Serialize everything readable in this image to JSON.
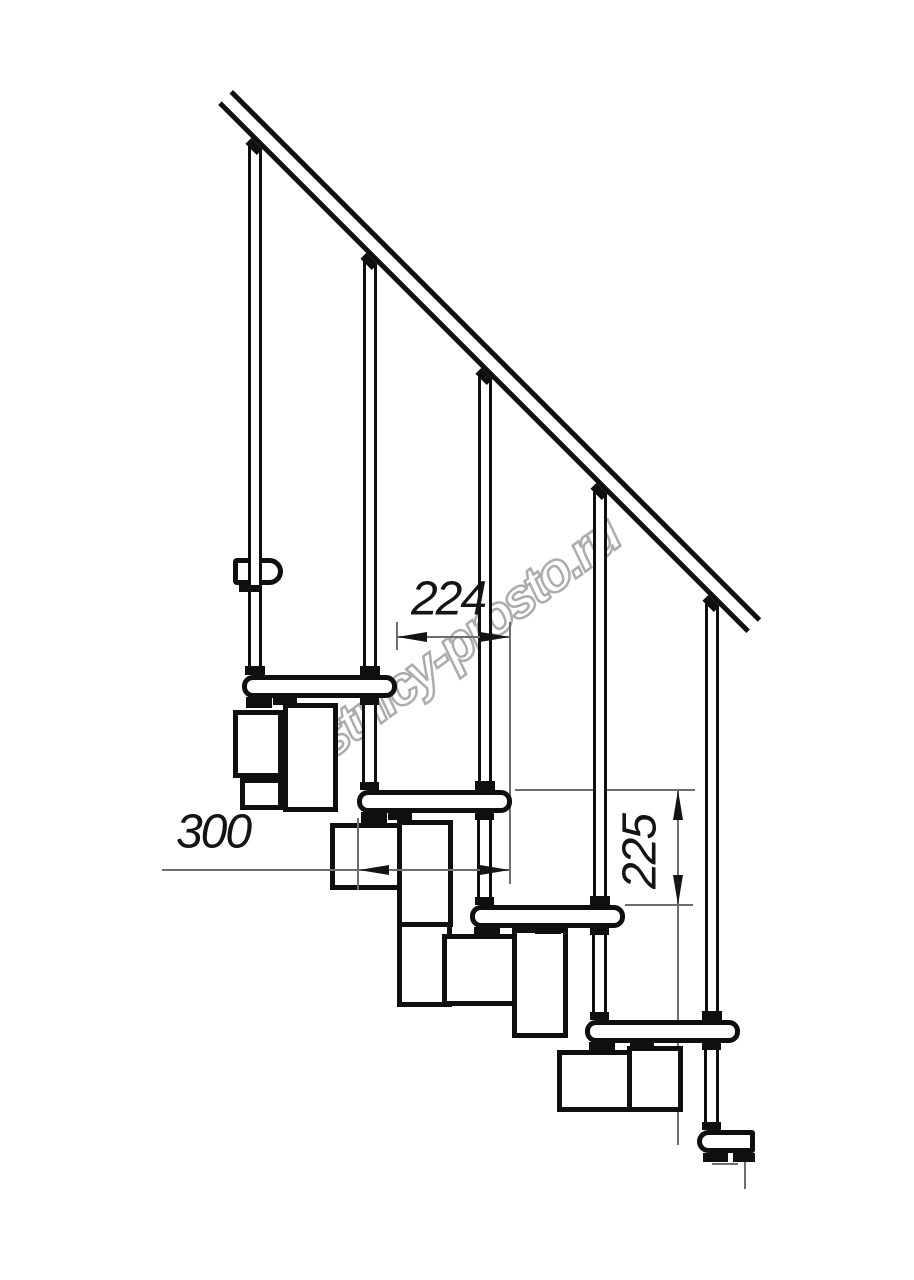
{
  "watermark": {
    "text": "lestnicy-prosto.ru"
  },
  "dimensions": {
    "step_run": {
      "label": "224"
    },
    "module_depth": {
      "label": "300"
    },
    "step_rise": {
      "label": "225"
    }
  },
  "colors": {
    "background": "#ffffff",
    "ink": "#0f0f0f",
    "thin_line": "#6e6e6e",
    "watermark_outline": "#acacac",
    "dimension_text": "#141414"
  },
  "geometry": {
    "handrail": {
      "x": 233,
      "y": 90,
      "length": 747,
      "thickness": 21,
      "angle_deg": 45
    },
    "treads": [
      [
        242,
        675,
        155,
        23
      ],
      [
        357,
        790,
        155,
        23
      ],
      [
        470,
        905,
        155,
        23
      ],
      [
        585,
        1020,
        155,
        23
      ]
    ],
    "rail_bracket": [
      233,
      558,
      50,
      27
    ],
    "floor_bracket": [
      697,
      1130,
      58,
      23
    ],
    "balusters": [
      [
        248,
        144,
        14,
        531
      ],
      [
        363,
        259,
        14,
        416
      ],
      [
        478,
        374,
        14,
        416
      ],
      [
        593,
        489,
        14,
        416
      ],
      [
        705,
        601,
        14,
        419
      ]
    ],
    "support_pipes": [
      [
        362,
        698,
        15,
        92
      ],
      [
        477,
        813,
        15,
        92
      ],
      [
        592,
        928,
        15,
        92
      ],
      [
        704,
        1043,
        15,
        87
      ]
    ],
    "module_boxes": [
      [
        233,
        710,
        50,
        68
      ],
      [
        240,
        778,
        43,
        32
      ],
      [
        283,
        703,
        55,
        109
      ],
      [
        330,
        823,
        73,
        67
      ],
      [
        397,
        820,
        56,
        107
      ],
      [
        397,
        922,
        55,
        85
      ],
      [
        442,
        934,
        76,
        72
      ],
      [
        512,
        928,
        56,
        110
      ],
      [
        557,
        1050,
        76,
        62
      ],
      [
        627,
        1046,
        56,
        66
      ]
    ],
    "rail_wedges": [
      [
        247,
        140,
        16,
        11
      ],
      [
        362,
        255,
        16,
        11
      ],
      [
        477,
        370,
        16,
        11
      ],
      [
        592,
        485,
        16,
        11
      ],
      [
        704,
        597,
        16,
        11
      ]
    ],
    "black_fills": [
      [
        245,
        666,
        20,
        9
      ],
      [
        360,
        666,
        20,
        9
      ],
      [
        475,
        781,
        20,
        9
      ],
      [
        590,
        896,
        20,
        9
      ],
      [
        702,
        1011,
        20,
        9
      ],
      [
        360,
        698,
        19,
        7
      ],
      [
        475,
        813,
        19,
        7
      ],
      [
        590,
        928,
        19,
        7
      ],
      [
        702,
        1043,
        19,
        7
      ],
      [
        360,
        782,
        19,
        8
      ],
      [
        475,
        897,
        19,
        8
      ],
      [
        590,
        1012,
        19,
        8
      ],
      [
        702,
        1122,
        19,
        8
      ],
      [
        246,
        697,
        26,
        11
      ],
      [
        361,
        812,
        26,
        11
      ],
      [
        474,
        927,
        26,
        10
      ],
      [
        589,
        1042,
        26,
        10
      ],
      [
        273,
        697,
        24,
        8
      ],
      [
        388,
        812,
        24,
        8
      ],
      [
        535,
        926,
        26,
        8
      ],
      [
        630,
        1041,
        24,
        7
      ],
      [
        239,
        585,
        20,
        7
      ],
      [
        703,
        1153,
        25,
        9
      ],
      [
        733,
        1153,
        22,
        9
      ]
    ],
    "lines_under": [
      [
        509,
        622,
        2,
        262
      ],
      [
        515,
        789,
        180,
        2
      ],
      [
        677,
        905,
        2,
        240
      ]
    ],
    "lines_over": [
      [
        396,
        622,
        2,
        28
      ],
      [
        396,
        636,
        114,
        2
      ],
      [
        162,
        869,
        348,
        2
      ],
      [
        357,
        818,
        2,
        72
      ],
      [
        625,
        904,
        68,
        2
      ],
      [
        677,
        790,
        2,
        115
      ],
      [
        712,
        1163,
        26,
        2
      ],
      [
        744,
        1162,
        2,
        27
      ]
    ],
    "arrows": [
      {
        "dir": "left",
        "x": 397,
        "y": 637
      },
      {
        "dir": "right",
        "x": 510,
        "y": 637
      },
      {
        "dir": "left",
        "x": 359,
        "y": 870
      },
      {
        "dir": "right",
        "x": 510,
        "y": 870
      },
      {
        "dir": "up",
        "x": 678,
        "y": 790
      },
      {
        "dir": "down",
        "x": 678,
        "y": 905
      }
    ]
  }
}
